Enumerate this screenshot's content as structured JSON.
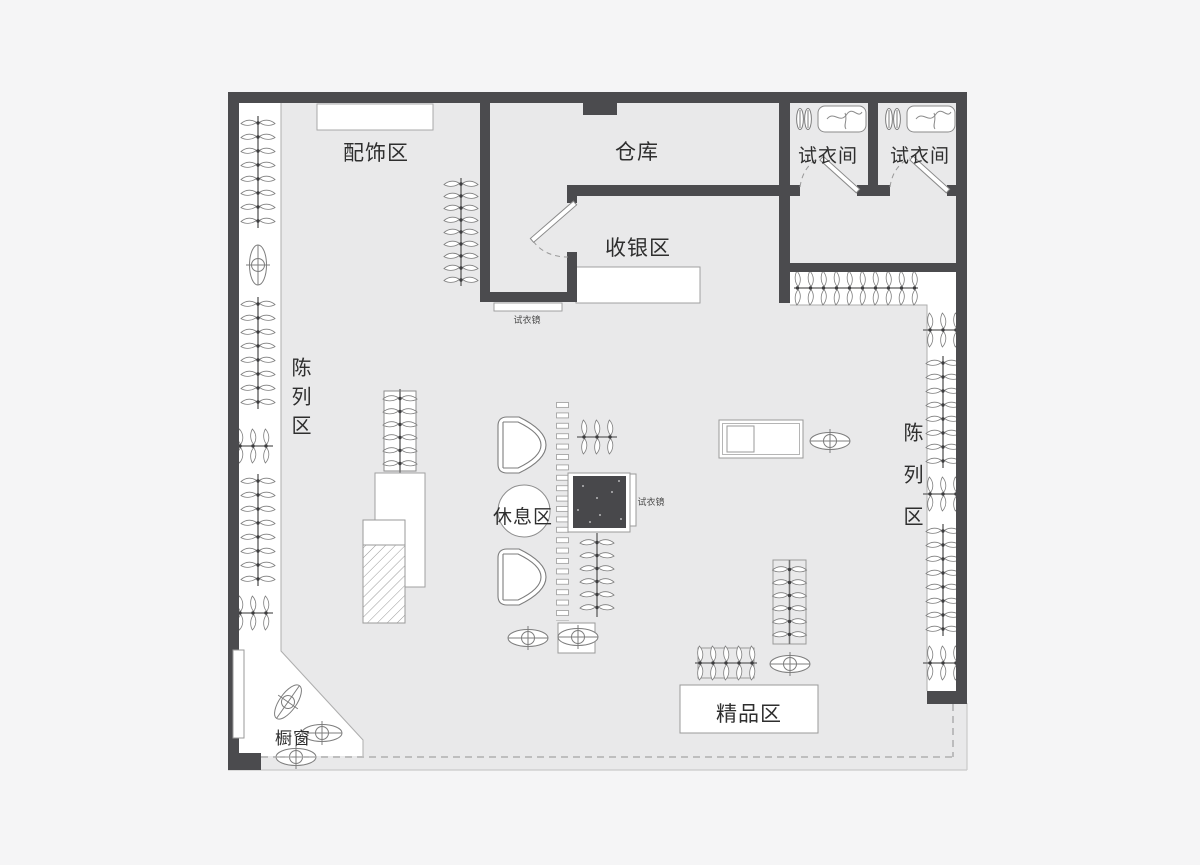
{
  "areas": {
    "accessories": {
      "label": "配饰区"
    },
    "warehouse": {
      "label": "仓库"
    },
    "fitting_room_1": {
      "label": "试衣间"
    },
    "fitting_room_2": {
      "label": "试衣间"
    },
    "cashier": {
      "label": "收银区"
    },
    "display_left": {
      "label": "陈列区"
    },
    "display_right": {
      "label": "陈列区"
    },
    "lounge": {
      "label": "休息区"
    },
    "boutique": {
      "label": "精品区"
    },
    "shop_window": {
      "label": "橱窗"
    }
  },
  "fixtures": {
    "mirror_cashier": {
      "label": "试衣镜"
    },
    "mirror_lounge": {
      "label": "试衣镜"
    }
  },
  "icons": [
    "clothes-hanger-icon",
    "door-swing-icon",
    "armchair-icon",
    "round-table-icon",
    "oval-display-icon",
    "rug-icon",
    "slat-display-icon",
    "shoes-icon",
    "bench-icon"
  ],
  "colors": {
    "background": "#f5f5f6",
    "floor": "#e9e9ea",
    "wall": "#4b4b4e",
    "fixture_white": "#ffffff",
    "line": "#a0a0a0",
    "rug": "#48484b"
  }
}
